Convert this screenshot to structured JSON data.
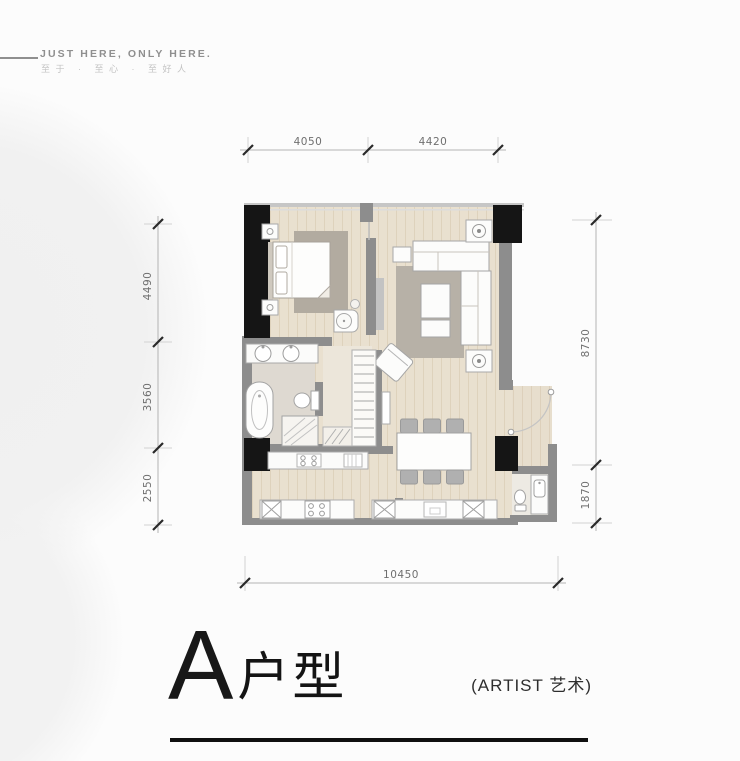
{
  "header": {
    "tagline_en": "JUST HERE, ONLY HERE.",
    "tagline_cn": "至于 · 至心 · 至好人"
  },
  "floor_plan": {
    "type": "apartment-floor-plan",
    "dimensions": {
      "top": [
        "4050",
        "4420"
      ],
      "left": [
        "4490",
        "3560",
        "2550"
      ],
      "right": [
        "8730",
        "1870"
      ],
      "bottom": [
        "10450"
      ]
    },
    "rooms": [
      "bedroom",
      "living-room",
      "bathroom",
      "closet",
      "kitchen",
      "dining",
      "entry",
      "utility"
    ]
  },
  "title": {
    "unit_letter": "A",
    "unit_suffix": "户型",
    "annotation": "(ARTIST 艺术)"
  },
  "colors": {
    "wall": "#8d8d8d",
    "column": "#151515",
    "floor_wood": "#e9e0cf",
    "rug": "#b2aba0",
    "underline": "#101010",
    "dim_text": "#6f6f6f"
  }
}
